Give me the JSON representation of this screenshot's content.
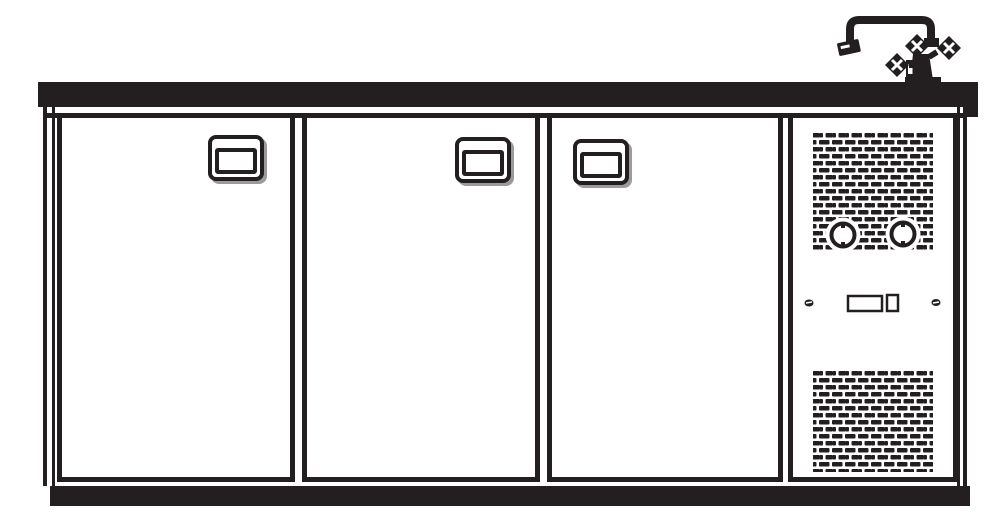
{
  "page": {
    "title": "Refrigerated back bar counter — front elevation technical drawing"
  },
  "colors": {
    "ink": "#231f20",
    "paper": "#ffffff"
  },
  "drawing": {
    "countertop": {
      "label": "Countertop worktop"
    },
    "faucet": {
      "label": "Gooseneck mixer tap with cross handles"
    },
    "doors": [
      {
        "label": "Refrigerator door 1",
        "handle_label": "Recessed door handle 1"
      },
      {
        "label": "Refrigerator door 2",
        "handle_label": "Recessed door handle 2"
      },
      {
        "label": "Refrigerator door 3",
        "handle_label": "Recessed door handle 3"
      }
    ],
    "unit": {
      "label": "Refrigeration unit housing",
      "top_vent_label": "Upper ventilation grille",
      "bottom_vent_label": "Lower ventilation grille",
      "knob_left_label": "Thermostat knob left",
      "knob_right_label": "Thermostat knob right",
      "switch_label": "Control switch",
      "indicator_label": "Indicator light",
      "screw_left_label": "Panel screw left",
      "screw_right_label": "Panel screw right"
    },
    "plinth": {
      "label": "Base plinth"
    }
  }
}
